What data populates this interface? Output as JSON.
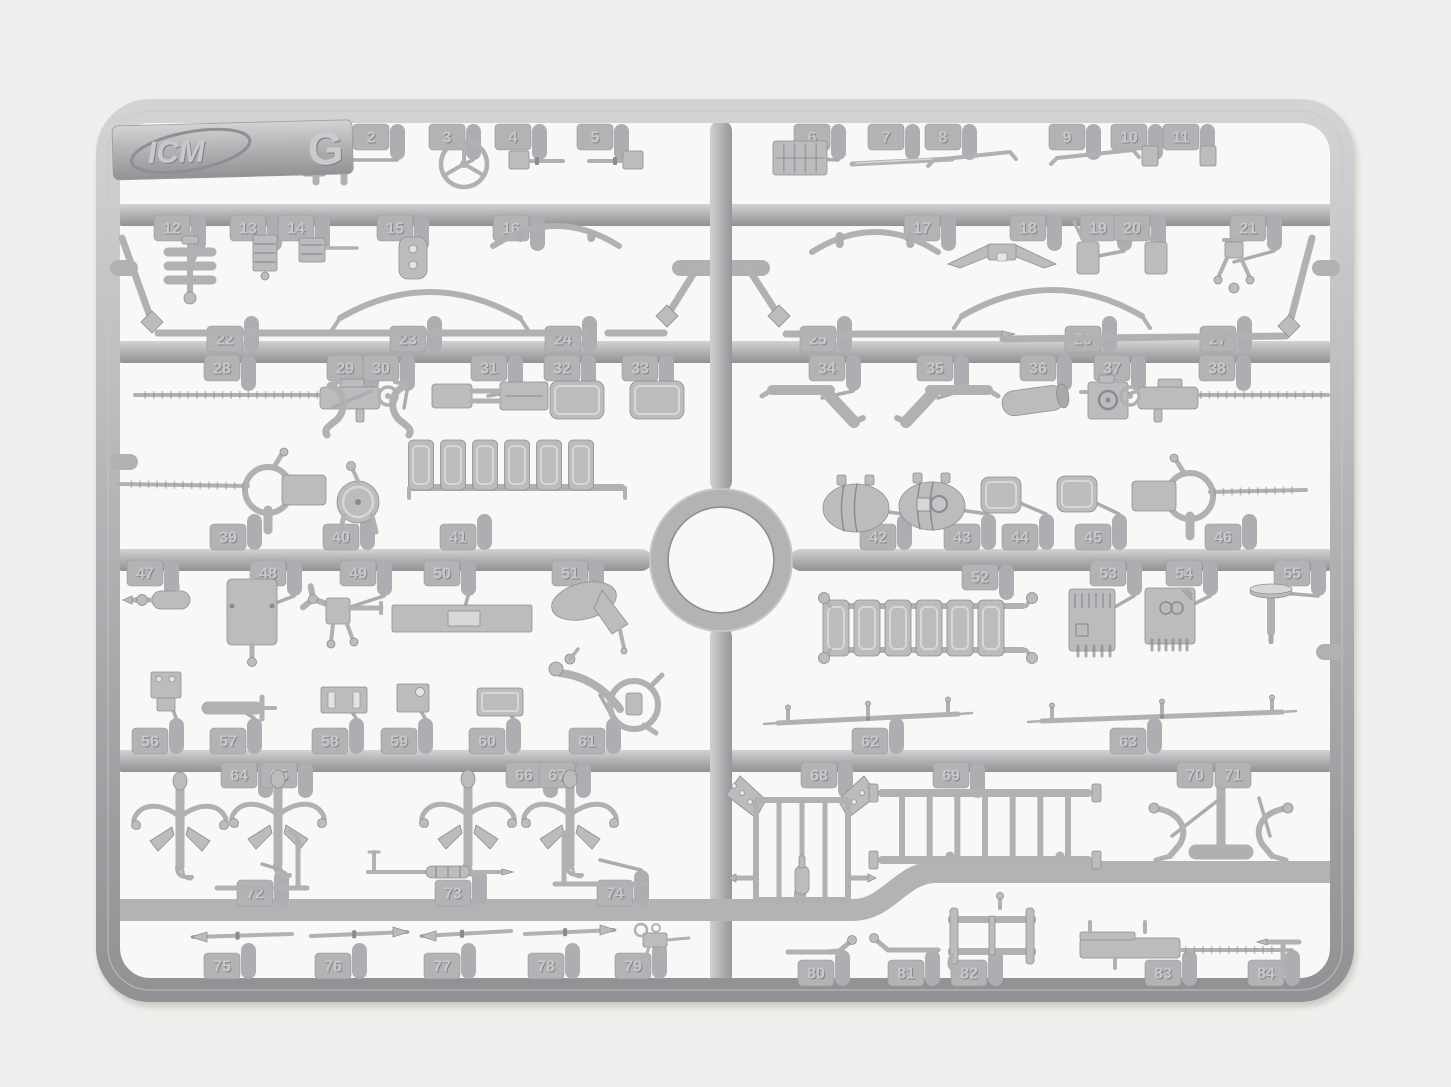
{
  "scene": {
    "description": "Photograph of a gray injection-molded plastic model kit sprue on a white background",
    "width": 1451,
    "height": 1087,
    "background": "#f0efed",
    "inner_background": "#f9f8f6",
    "plastic": {
      "base": "#b6b6b9",
      "rod": "#b1b1b4",
      "fill": "#bcbcbf",
      "light": "#d7d7d9",
      "dark": "#8b8b8f",
      "stroke": "#8e8e91",
      "hole": "#e4e4e6",
      "tab": "#b3b3b6",
      "gate": "#aeaeb2",
      "emboss_light": "#c9c9cc",
      "emboss_dark": "#85858a"
    }
  },
  "logo": {
    "brand": "ICM",
    "sprue_letter": "G"
  },
  "structure": {
    "frame": {
      "x": 108,
      "y": 111,
      "w": 1234,
      "h": 879,
      "r": 42,
      "bar": 24
    },
    "spine": [
      {
        "x": 721,
        "y1": 120,
        "y2": 492
      },
      {
        "x": 721,
        "y1": 626,
        "y2": 986
      }
    ],
    "ring": {
      "cx": 721,
      "cy": 560,
      "r": 62,
      "bar": 20
    },
    "rails": [
      {
        "y": 215,
        "x1": 112,
        "x2": 1338
      },
      {
        "y": 352,
        "x1": 112,
        "x2": 1338
      },
      {
        "y": 560,
        "x1": 112,
        "x2": 652
      },
      {
        "y": 560,
        "x1": 790,
        "x2": 1338
      },
      {
        "y": 761,
        "x1": 112,
        "x2": 1338
      }
    ],
    "jog": "M111 910 H853 C888 910 901 872 936 872 H1339",
    "nubs": [
      [
        124,
        268
      ],
      [
        124,
        462
      ],
      [
        1326,
        268
      ],
      [
        1330,
        652
      ]
    ],
    "extras": [
      [
        680,
        268,
        762,
        268,
        16
      ],
      [
        800,
        893,
        800,
        907,
        12
      ],
      [
        950,
        856,
        950,
        872,
        9
      ],
      [
        1060,
        856,
        1060,
        872,
        9
      ],
      [
        1221,
        786,
        1221,
        848,
        9
      ],
      [
        1196,
        852,
        1246,
        852,
        15
      ]
    ]
  },
  "parts": [
    {
      "n": "1",
      "t": [
        300,
        137
      ],
      "d": "d",
      "k": "box",
      "p": [
        314,
        166,
        24,
        20,
        3
      ]
    },
    {
      "n": "2",
      "t": [
        371,
        137
      ],
      "d": "d",
      "k": "ubracket",
      "p": [
        330,
        160
      ]
    },
    {
      "n": "3",
      "t": [
        447,
        137
      ],
      "d": "d",
      "k": "wheel",
      "p": [
        464,
        164,
        23
      ]
    },
    {
      "n": "4",
      "t": [
        513,
        137
      ],
      "d": "d",
      "k": "nozzle",
      "p": [
        535,
        160,
        1
      ]
    },
    {
      "n": "5",
      "t": [
        595,
        137
      ],
      "d": "d",
      "k": "nozzle",
      "p": [
        617,
        160,
        -1
      ]
    },
    {
      "n": "6",
      "t": [
        812,
        137
      ],
      "d": "d",
      "k": "grill",
      "p": [
        800,
        158,
        54,
        34
      ]
    },
    {
      "n": "7",
      "t": [
        886,
        137
      ],
      "d": "d",
      "k": "blade",
      "p": [
        852,
        164,
        952,
        159
      ]
    },
    {
      "n": "8",
      "t": [
        943,
        137
      ],
      "d": "d",
      "k": "wiper",
      "p": [
        928,
        160,
        1016,
        152
      ]
    },
    {
      "n": "9",
      "t": [
        1067,
        137
      ],
      "d": "d",
      "k": "wiper",
      "p": [
        1051,
        158,
        1139,
        150
      ]
    },
    {
      "n": "10",
      "t": [
        1129,
        137
      ],
      "d": "d",
      "k": "box",
      "p": [
        1150,
        156,
        16,
        20,
        2
      ]
    },
    {
      "n": "11",
      "t": [
        1181,
        137
      ],
      "d": "d",
      "k": "box",
      "p": [
        1208,
        156,
        16,
        20,
        2
      ]
    },
    {
      "n": "12",
      "t": [
        172,
        228
      ],
      "d": "d",
      "k": "stack",
      "p": [
        190,
        268
      ]
    },
    {
      "n": "13",
      "t": [
        248,
        228
      ],
      "d": "d",
      "k": "ribbed",
      "p": [
        265,
        253
      ]
    },
    {
      "n": "14",
      "t": [
        296,
        228
      ],
      "d": "d",
      "k": "pinblock",
      "p": [
        312,
        250
      ]
    },
    {
      "n": "15",
      "t": [
        395,
        228
      ],
      "d": "d",
      "k": "holeplate",
      "p": [
        413,
        258
      ]
    },
    {
      "n": "16",
      "t": [
        511,
        228
      ],
      "d": "d",
      "k": "bow",
      "p": [
        493,
        246,
        619,
        246,
        -20,
        1
      ]
    },
    {
      "n": "17",
      "t": [
        922,
        228
      ],
      "d": "d",
      "k": "bow",
      "p": [
        812,
        252,
        938,
        252,
        -20,
        1
      ]
    },
    {
      "n": "18",
      "t": [
        1028,
        228
      ],
      "d": "d",
      "k": "emblem",
      "p": [
        1002,
        254
      ]
    },
    {
      "n": "19",
      "t": [
        1098,
        228
      ],
      "d": "d",
      "k": "paddle",
      "p": [
        1088,
        258
      ]
    },
    {
      "n": "20",
      "t": [
        1132,
        228
      ],
      "d": "d",
      "k": "paddle",
      "p": [
        1156,
        258
      ]
    },
    {
      "n": "21",
      "t": [
        1248,
        228
      ],
      "d": "d",
      "k": "mount21",
      "p": [
        1234,
        262
      ]
    },
    {
      "n": "22",
      "t": [
        225,
        339
      ],
      "d": "u",
      "k": "rodasm",
      "p": [
        158,
        333,
        585,
        333,
        122,
        238,
        152,
        322
      ]
    },
    {
      "n": "23",
      "t": [
        408,
        339
      ],
      "d": "u",
      "k": "bowfeet",
      "p": [
        340,
        318,
        520,
        318,
        -26
      ]
    },
    {
      "n": "24",
      "t": [
        563,
        339
      ],
      "d": "u",
      "k": "rodasm",
      "p": [
        608,
        333,
        664,
        333,
        697,
        268,
        667,
        316
      ]
    },
    {
      "n": "25",
      "t": [
        818,
        339
      ],
      "d": "u",
      "k": "rodasm3",
      "p": [
        786,
        334,
        1002,
        334,
        748,
        268,
        779,
        316
      ]
    },
    {
      "n": "26",
      "t": [
        1083,
        339
      ],
      "d": "u",
      "k": "bowfeet",
      "p": [
        962,
        316,
        1142,
        316,
        -26
      ]
    },
    {
      "n": "27",
      "t": [
        1218,
        339
      ],
      "d": "u",
      "k": "rodasm",
      "p": [
        1003,
        339,
        1286,
        336,
        1312,
        238,
        1289,
        326
      ]
    },
    {
      "n": "28",
      "t": [
        222,
        368
      ],
      "d": "d",
      "k": "mg",
      "p": [
        350,
        398,
        -1,
        185
      ]
    },
    {
      "n": "29",
      "t": [
        345,
        368
      ],
      "d": "d",
      "k": "hook",
      "p": [
        332,
        408,
        1
      ]
    },
    {
      "n": "30",
      "t": [
        381,
        368
      ],
      "d": "d",
      "k": "hook",
      "p": [
        404,
        408,
        -1
      ]
    },
    {
      "n": "31",
      "t": [
        489,
        368
      ],
      "d": "d",
      "k": "boxasm",
      "p": [
        488,
        396
      ]
    },
    {
      "n": "32",
      "t": [
        562,
        368
      ],
      "d": "d",
      "k": "rbox",
      "p": [
        577,
        400,
        54,
        38,
        8
      ]
    },
    {
      "n": "33",
      "t": [
        640,
        368
      ],
      "d": "d",
      "k": "rbox",
      "p": [
        657,
        400,
        54,
        38,
        8
      ]
    },
    {
      "n": "34",
      "t": [
        827,
        368
      ],
      "d": "d",
      "k": "grip",
      "p": [
        822,
        398,
        1
      ]
    },
    {
      "n": "35",
      "t": [
        935,
        368
      ],
      "d": "d",
      "k": "grip",
      "p": [
        938,
        398,
        -1
      ]
    },
    {
      "n": "36",
      "t": [
        1038,
        368
      ],
      "d": "d",
      "k": "cyl",
      "p": [
        1034,
        400
      ]
    },
    {
      "n": "37",
      "t": [
        1112,
        368
      ],
      "d": "d",
      "k": "sbox37",
      "p": [
        1108,
        400
      ]
    },
    {
      "n": "38",
      "t": [
        1217,
        368
      ],
      "d": "d",
      "k": "mg",
      "p": [
        1168,
        398,
        1,
        130
      ]
    },
    {
      "n": "39",
      "t": [
        228,
        537
      ],
      "d": "u",
      "k": "mgmount",
      "p": [
        268,
        490,
        -1,
        118
      ]
    },
    {
      "n": "40",
      "t": [
        341,
        537
      ],
      "d": "u",
      "k": "light",
      "p": [
        358,
        502
      ]
    },
    {
      "n": "41",
      "t": [
        458,
        537
      ],
      "d": "u",
      "k": "bench",
      "p": [
        517,
        440
      ]
    },
    {
      "n": "42",
      "t": [
        878,
        537
      ],
      "d": "u",
      "k": "tank",
      "p": [
        856,
        508,
        0
      ]
    },
    {
      "n": "43",
      "t": [
        962,
        537
      ],
      "d": "u",
      "k": "tank",
      "p": [
        932,
        506,
        1
      ]
    },
    {
      "n": "44",
      "t": [
        1020,
        537
      ],
      "d": "u",
      "k": "rbox",
      "p": [
        1001,
        495,
        40,
        36,
        8
      ]
    },
    {
      "n": "45",
      "t": [
        1093,
        537
      ],
      "d": "u",
      "k": "rbox",
      "p": [
        1077,
        494,
        40,
        36,
        8
      ]
    },
    {
      "n": "46",
      "t": [
        1223,
        537
      ],
      "d": "u",
      "k": "mgmount",
      "p": [
        1190,
        496,
        1,
        1306
      ]
    },
    {
      "n": "47",
      "t": [
        145,
        573
      ],
      "d": "d",
      "k": "pump",
      "p": [
        170,
        600
      ]
    },
    {
      "n": "48",
      "t": [
        268,
        573
      ],
      "d": "d",
      "k": "plate48",
      "p": [
        252,
        612
      ]
    },
    {
      "n": "49",
      "t": [
        358,
        573
      ],
      "d": "d",
      "k": "valve",
      "p": [
        335,
        612
      ]
    },
    {
      "n": "50",
      "t": [
        442,
        573
      ],
      "d": "d",
      "k": "barplate",
      "p": [
        462,
        618
      ]
    },
    {
      "n": "51",
      "t": [
        570,
        573
      ],
      "d": "d",
      "k": "horn",
      "p": [
        594,
        606
      ]
    },
    {
      "n": "52",
      "t": [
        980,
        577
      ],
      "d": "d",
      "k": "bench2",
      "p": [
        928,
        628
      ]
    },
    {
      "n": "53",
      "t": [
        1108,
        573
      ],
      "d": "d",
      "k": "panel53",
      "p": [
        1092,
        620
      ]
    },
    {
      "n": "54",
      "t": [
        1184,
        573
      ],
      "d": "d",
      "k": "panel54",
      "p": [
        1170,
        616
      ]
    },
    {
      "n": "55",
      "t": [
        1292,
        573
      ],
      "d": "d",
      "k": "mushroom",
      "p": [
        1271,
        592
      ]
    },
    {
      "n": "56",
      "t": [
        150,
        741
      ],
      "d": "u",
      "k": "box56",
      "p": [
        166,
        690
      ]
    },
    {
      "n": "57",
      "t": [
        228,
        741
      ],
      "d": "u",
      "k": "tbar57",
      "p": [
        238,
        708
      ]
    },
    {
      "n": "58",
      "t": [
        330,
        741
      ],
      "d": "u",
      "k": "slotplate",
      "p": [
        344,
        700
      ]
    },
    {
      "n": "59",
      "t": [
        399,
        741
      ],
      "d": "u",
      "k": "holebox",
      "p": [
        413,
        698
      ]
    },
    {
      "n": "60",
      "t": [
        487,
        741
      ],
      "d": "u",
      "k": "rbox",
      "p": [
        500,
        702,
        46,
        28,
        3
      ]
    },
    {
      "n": "61",
      "t": [
        587,
        741
      ],
      "d": "u",
      "k": "column61",
      "p": [
        600,
        695
      ]
    },
    {
      "n": "62",
      "t": [
        870,
        741
      ],
      "d": "u",
      "k": "spring",
      "p": [
        778,
        723,
        958,
        714
      ]
    },
    {
      "n": "63",
      "t": [
        1128,
        741
      ],
      "d": "u",
      "k": "spring",
      "p": [
        1042,
        721,
        1282,
        712
      ]
    },
    {
      "n": "64",
      "t": [
        239,
        775
      ],
      "d": "d",
      "k": "cluster",
      "p": [
        180,
        825
      ]
    },
    {
      "n": "65",
      "t": [
        279,
        775
      ],
      "d": "d",
      "k": "cluster",
      "p": [
        278,
        823
      ]
    },
    {
      "n": "66",
      "t": [
        524,
        775
      ],
      "d": "d",
      "k": "cluster",
      "p": [
        468,
        823
      ]
    },
    {
      "n": "67",
      "t": [
        557,
        775
      ],
      "d": "d",
      "k": "cluster",
      "p": [
        570,
        823
      ]
    },
    {
      "n": "68",
      "t": [
        819,
        775
      ],
      "d": "d",
      "k": "rack68",
      "p": [
        802,
        848
      ]
    },
    {
      "n": "69",
      "t": [
        951,
        775
      ],
      "d": "d",
      "k": "ladder",
      "p": [
        878,
        793,
        1092,
        860,
        7
      ]
    },
    {
      "n": "70",
      "t": [
        1195,
        775
      ],
      "d": "d",
      "k": "hook70",
      "p": [
        1172,
        836,
        -1
      ],
      "ng": 1
    },
    {
      "n": "71",
      "t": [
        1233,
        775
      ],
      "d": "d",
      "k": "hook70",
      "p": [
        1270,
        836,
        1
      ],
      "ng": 1
    },
    {
      "n": "72",
      "t": [
        255,
        893
      ],
      "d": "u",
      "k": "bracket72",
      "p": [
        262,
        864,
        1
      ]
    },
    {
      "n": "73",
      "t": [
        453,
        893
      ],
      "d": "u",
      "k": "gunrod",
      "p": [
        436,
        872
      ]
    },
    {
      "n": "74",
      "t": [
        615,
        893
      ],
      "d": "u",
      "k": "bracket72",
      "p": [
        600,
        860,
        -1
      ]
    },
    {
      "n": "75",
      "t": [
        222,
        966
      ],
      "d": "u",
      "k": "tiprod",
      "p": [
        193,
        937,
        292,
        934
      ],
      "tip": "L"
    },
    {
      "n": "76",
      "t": [
        333,
        966
      ],
      "d": "u",
      "k": "tiprod",
      "p": [
        311,
        936,
        407,
        932
      ],
      "tip": "R"
    },
    {
      "n": "77",
      "t": [
        442,
        966
      ],
      "d": "u",
      "k": "tiprod",
      "p": [
        422,
        936,
        511,
        931
      ],
      "tip": "L"
    },
    {
      "n": "78",
      "t": [
        546,
        966
      ],
      "d": "u",
      "k": "tiprod",
      "p": [
        525,
        934,
        614,
        930
      ],
      "tip": "R"
    },
    {
      "n": "79",
      "t": [
        633,
        966
      ],
      "d": "u",
      "k": "mg79",
      "p": [
        655,
        940
      ]
    },
    {
      "n": "80",
      "t": [
        816,
        973
      ],
      "d": "u",
      "k": "lever",
      "p": [
        818,
        952,
        1
      ]
    },
    {
      "n": "81",
      "t": [
        906,
        973
      ],
      "d": "u",
      "k": "lever",
      "p": [
        908,
        950,
        -1
      ]
    },
    {
      "n": "82",
      "t": [
        969,
        973
      ],
      "d": "u",
      "k": "hframe",
      "p": [
        992,
        938
      ]
    },
    {
      "n": "83",
      "t": [
        1163,
        973
      ],
      "d": "u",
      "k": "mg83",
      "p": [
        1135,
        948
      ]
    },
    {
      "n": "84",
      "t": [
        1266,
        973
      ],
      "d": "u",
      "k": "trod",
      "p": [
        1283,
        950
      ]
    }
  ]
}
